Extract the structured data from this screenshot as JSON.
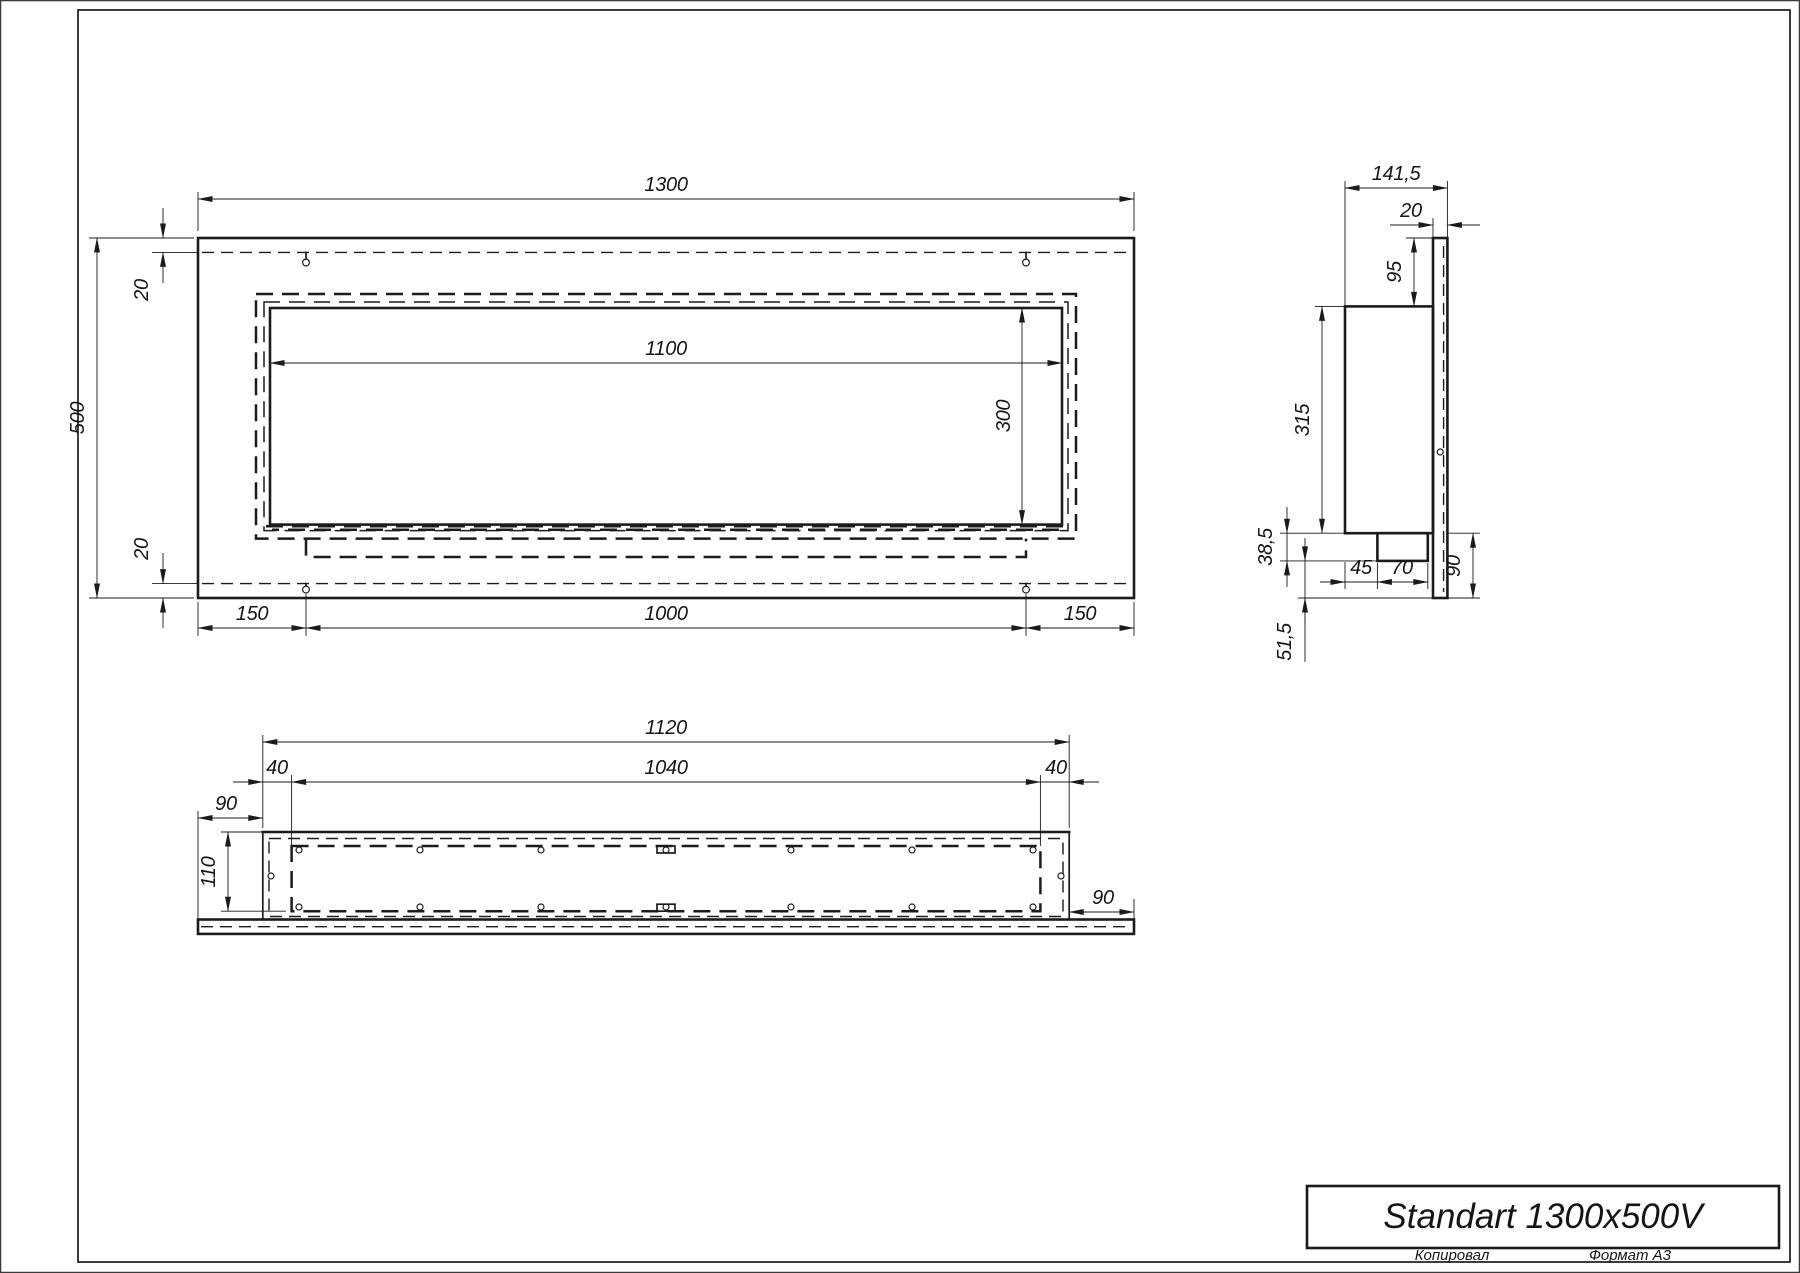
{
  "drawing_title": "Standart 1300x500V",
  "footer": {
    "copied_by": "Копировал",
    "format": "Формат А3"
  },
  "front_view": {
    "width": "1300",
    "height": "500",
    "top_inset": "20",
    "bottom_inset": "20",
    "opening_width": "1100",
    "opening_height": "300",
    "mount_offset_left": "150",
    "mount_spacing": "1000",
    "mount_offset_right": "150"
  },
  "side_view": {
    "depth": "141,5",
    "frame_thickness": "20",
    "top_flange": "95",
    "body_height": "315",
    "tray_drop": "38,5",
    "tray_offset": "45",
    "tray_depth": "70",
    "bottom_flange": "90",
    "bottom_gap": "51,5"
  },
  "bottom_view": {
    "body_width": "1120",
    "opening_width": "1040",
    "inset_left": "40",
    "inset_right": "40",
    "flange_overhang_left": "90",
    "opening_depth": "110",
    "flange_overhang_right": "90"
  }
}
